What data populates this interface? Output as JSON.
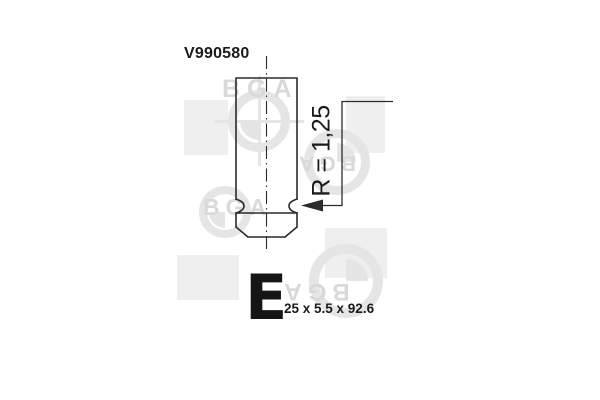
{
  "drawing": {
    "part_number": "V990580",
    "valve_type_letter": "E",
    "size_text": "25 x 5.5 x 92.6",
    "radius_label": "R = 1,25"
  },
  "watermark": {
    "brand": "BGA"
  },
  "colors": {
    "line": "#2b2b2b",
    "text": "#1b1b1b",
    "watermark_square": "#efefef",
    "watermark_shape": "#e5e5e5",
    "watermark_text": "#d9d9d9"
  }
}
